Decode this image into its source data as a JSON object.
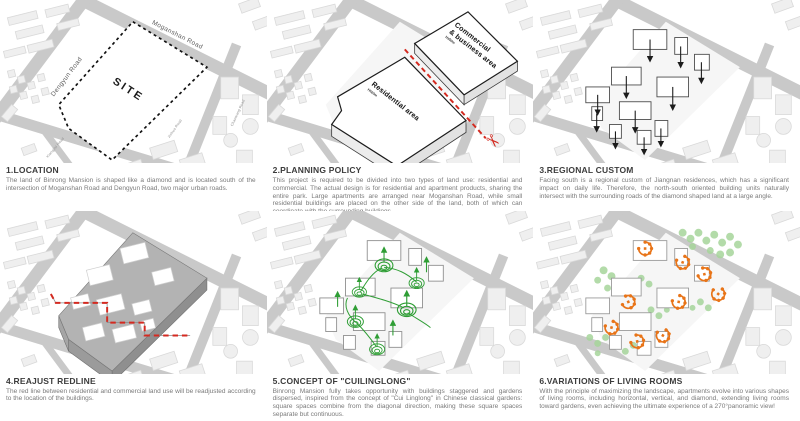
{
  "colors": {
    "background": "#ffffff",
    "road_grey": "#c9c9c9",
    "ground_grey": "#f4f4f4",
    "context_block": "#efefef",
    "redline": "#d42a20",
    "dark_slab": "#b3b3b3",
    "garden_green": "#2f9e35",
    "tree_green": "#a6d59b",
    "view_orange": "#e87418",
    "title_text": "#3c3c3c",
    "body_text": "#7a7a7a"
  },
  "panels": [
    {
      "title": "1.LOCATION",
      "body": "The land of Binrong Mansion is shaped like a diamond and is located south of the intersection of Moganshan Road and Dengyun Road, two major urban roads.",
      "labels": {
        "site": "SITE",
        "road_moganshan": "Moganshan Road",
        "road_dengyun": "Dengyun Road",
        "road_jinhua": "Jinhua Road",
        "road_chaowang": "Chaowang Road",
        "road_xiangjisi": "Xiangjisi Road"
      }
    },
    {
      "title": "2.PLANNING POLICY",
      "body": "This project is required to be divided into two types of land use: residential and commercial. The actual design is for residential and apartment products, sharing the entire park. Large apartments are arranged near Moganshan Road, while small residential buildings are placed on the other side of the land, both of which can coordinate with the surrounding buildings.",
      "labels": {
        "commercial_line1": "Commercial",
        "commercial_line2": "& business area",
        "commercial_height": "H≤50m",
        "residential": "Residential area",
        "residential_height": "H≤60m"
      }
    },
    {
      "title": "3.REGIONAL CUSTOM",
      "body": "Facing south is a regional custom of Jiangnan residences, which has a significant impact on daily life. Therefore, the north-south oriented building units naturally intersect with the surrounding roads of the diamond shaped land at a large angle.",
      "labels": {}
    },
    {
      "title": "4.REAJUST REDLINE",
      "body": "The red line between residential and commercial land use will be readjusted according to the location of the buildings.",
      "labels": {}
    },
    {
      "title": "5.CONCEPT OF \"CUILINGLONG\"",
      "body": "Binrong Mansion fully takes opportunity with buildings staggered and gardens dispersed, inspired from the concept of \"Cui Linglong\" in Chinese classical gardens: square spaces combine from the diagonal direction, making these square spaces separate but continuous.",
      "labels": {}
    },
    {
      "title": "6.VARIATIONS OF LIVING ROOMS",
      "body": "With the principle of maximizing the landscape, apartments evolve into various shapes of living rooms, including horizontal, vertical, and diamond, extending living rooms toward gardens, even achieving the ultimate experience of a 270°panoramic view!",
      "labels": {}
    }
  ]
}
